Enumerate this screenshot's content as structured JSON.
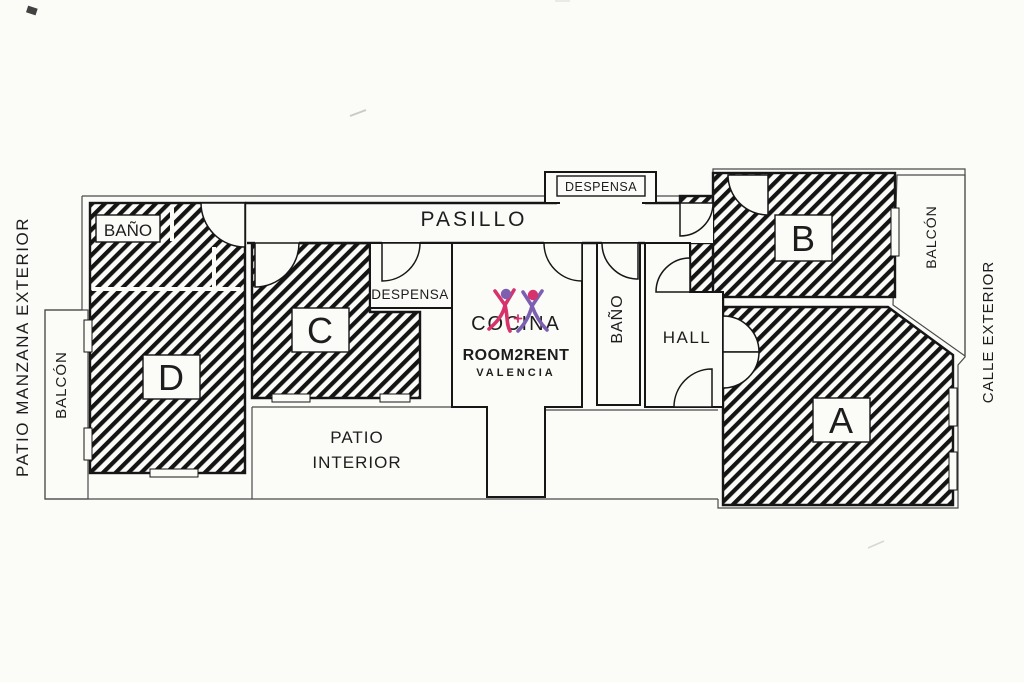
{
  "labels": {
    "pasillo": "PASILLO",
    "despensa_top": "DESPENSA",
    "despensa_mid": "DESPENSA",
    "bano_left": "BAÑO",
    "bano_mid": "BAÑO",
    "hall": "HALL",
    "cocina": "COCINA",
    "patio_line1": "PATIO",
    "patio_line2": "INTERIOR",
    "patio_manzana": "PATIO MANZANA EXTERIOR",
    "balcon_left": "BALCÓN",
    "balcon_right": "BALCÓN",
    "calle_exterior": "CALLE EXTERIOR",
    "room_a": "A",
    "room_b": "B",
    "room_c": "C",
    "room_d": "D"
  },
  "logo": {
    "brand": "ROOM2RENT",
    "city": "VALENCIA",
    "brand_color": "#d6336c",
    "city_color": "#6c58b0"
  },
  "colors": {
    "ink": "#161616",
    "paper": "#fbfbf8"
  }
}
